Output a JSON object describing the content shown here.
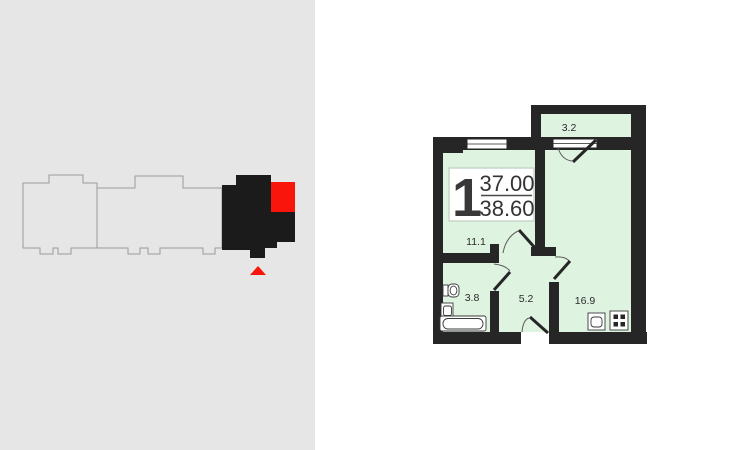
{
  "app": {
    "view": "apartment-floor-plan-viewer"
  },
  "building_minimap": {
    "sections_total": 3,
    "selected_section_index": 2,
    "marker": "entrance-triangle"
  },
  "floor_plan": {
    "unit_number": "1",
    "area_primary": "37.00",
    "area_secondary": "38.60",
    "rooms": [
      {
        "id": "balcony",
        "area": "3.2"
      },
      {
        "id": "room",
        "area": "11.1"
      },
      {
        "id": "bathroom",
        "area": "3.8"
      },
      {
        "id": "hallway",
        "area": "5.2"
      },
      {
        "id": "kitchen",
        "area": "16.9"
      }
    ],
    "fixtures": [
      "toilet-icon",
      "sink-icon",
      "bathtub-icon",
      "kitchen-sink-icon",
      "stove-icon"
    ]
  },
  "colors": {
    "panel_bg": "#e6e6e6",
    "page_bg": "#ffffff",
    "wall": "#262626",
    "room_fill": "#dff3e1",
    "accent_red": "#f9150b",
    "outline_gray": "#9b9b9b",
    "section_black": "#1b1b1b",
    "text": "#2b2b2b",
    "box_border": "#c9d5c9"
  }
}
